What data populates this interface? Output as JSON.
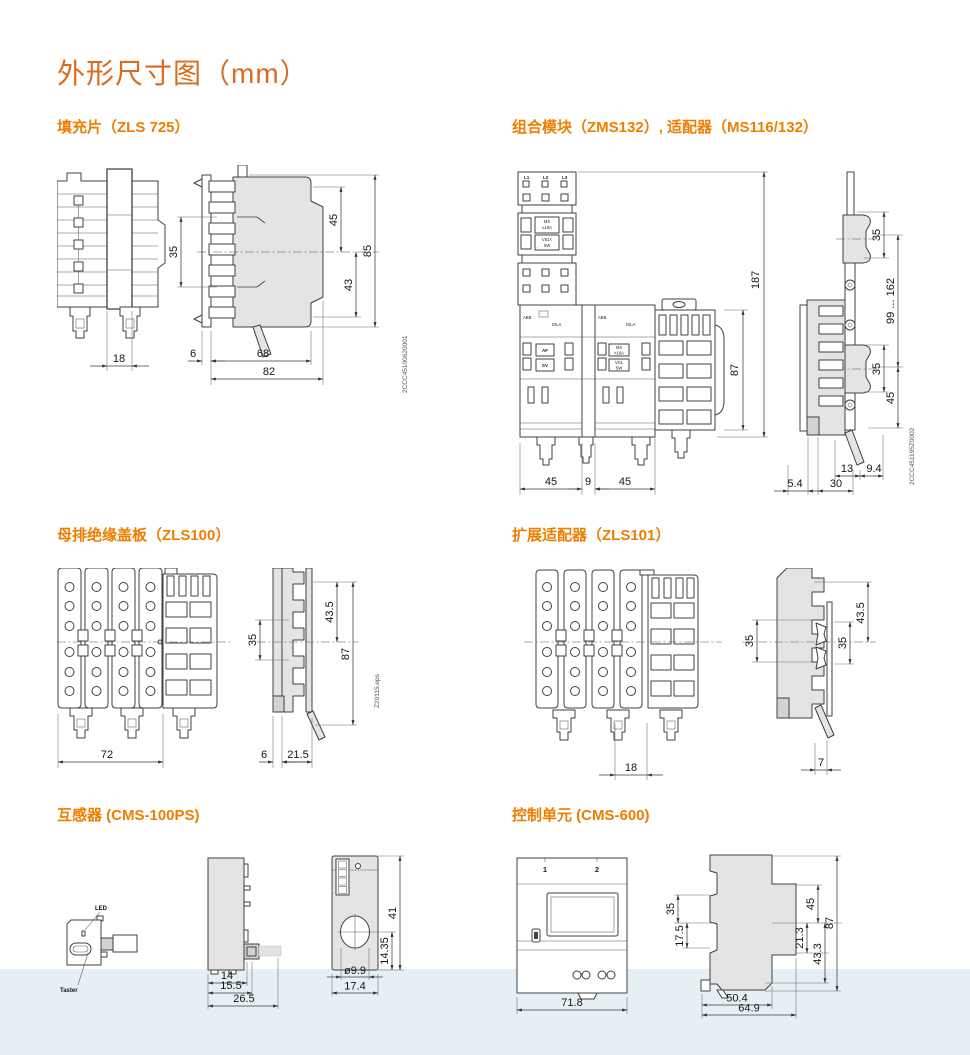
{
  "page": {
    "title": "外形尺寸图（mm）"
  },
  "colors": {
    "accent": "#ef7d00",
    "title": "#d96c1f",
    "band": "#e6eff4",
    "line": "#404040"
  },
  "sections": [
    {
      "heading": "填充片（ZLS 725）",
      "doc": "2CCC45100620001",
      "dims": {
        "strip": "18",
        "pitch": "35",
        "upper": "45",
        "lower": "43",
        "height": "85",
        "rear": "6",
        "body": "68",
        "total": "82"
      }
    },
    {
      "heading": "组合模块（ZMS132）, 适配器（MS116/132）",
      "doc": "2CCC451195Z0002",
      "labels": {
        "l1": "L1",
        "l2": "L2",
        "l3": "L3",
        "abb": "ABB",
        "dila": "DILA",
        "af": "AF",
        "sv": "SV",
        "ms": "MS",
        "a16": "≤16A",
        "vs1": "VS1<",
        "sw": "SW",
        "gt16a": ">16A",
        "vs2": "VS1"
      },
      "dims": {
        "total_height": "187",
        "module_height": "87",
        "w1": "45",
        "w2": "9",
        "w3": "45",
        "rail_pitch_top": "35",
        "range": "99 ... 162",
        "rail_pitch_mid": "35",
        "lower": "45",
        "d13": "13",
        "d9_4": "9.4",
        "d5_4": "5.4",
        "d30": "30"
      }
    },
    {
      "heading": "母排绝缘盖板（ZLS100）",
      "doc": "Z20115.eps",
      "dims": {
        "width": "72",
        "pitch": "35",
        "upper": "43.5",
        "height": "87",
        "rear": "6",
        "depth": "21.5"
      }
    },
    {
      "heading": "扩展适配器（ZLS101）",
      "dims": {
        "width": "18",
        "pitch_left": "35",
        "pitch_right": "35",
        "upper": "43.5",
        "depth": "7"
      }
    },
    {
      "heading": "互感器 (CMS-100PS)",
      "labels": {
        "led": "LED",
        "taster": "Taster"
      },
      "dims": {
        "d14": "14",
        "d15_5": "15.5",
        "d26_5": "26.5",
        "h41": "41",
        "h14_35": "14.35",
        "dia": "ø9.9",
        "w17_4": "17.4"
      }
    },
    {
      "heading": "控制单元 (CMS-600)",
      "labels": {
        "n1": "1",
        "n2": "2"
      },
      "dims": {
        "w71_8": "71.8",
        "p35": "35",
        "p17_5": "17.5",
        "r45": "45",
        "r87": "87",
        "r21_3": "21.3",
        "r43_3": "43.3",
        "b50_4": "50.4",
        "b64_9": "64.9"
      }
    }
  ]
}
